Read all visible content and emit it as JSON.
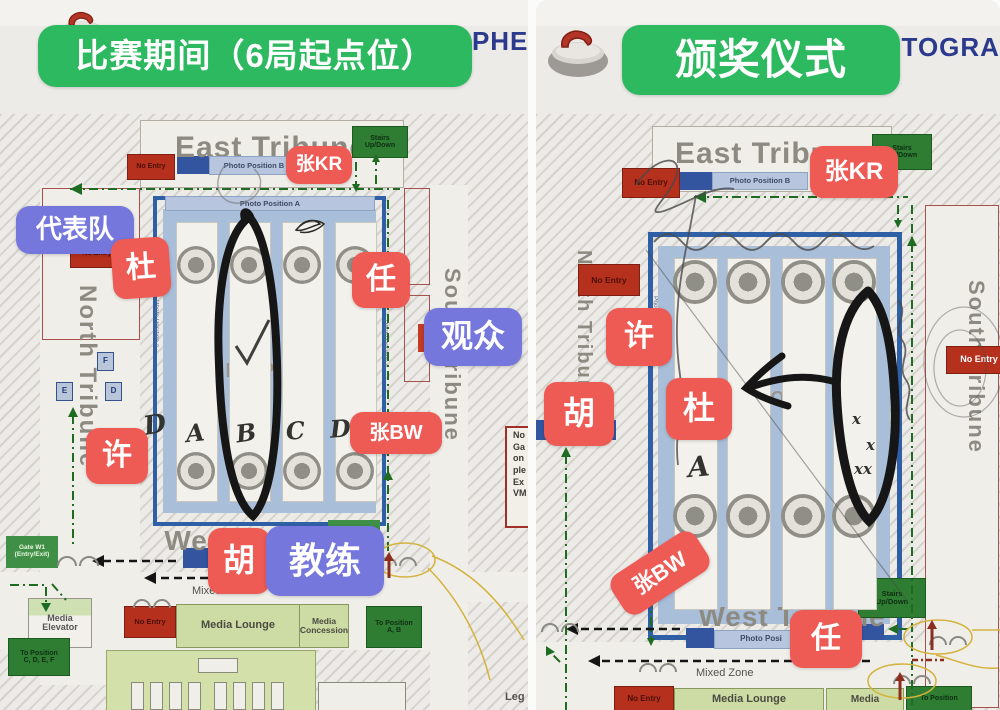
{
  "doc_title": "NAC MAP FOR PHOTOGRAPHERS",
  "colors": {
    "banner_green": "#2cb95f",
    "label_red": "#ee5a54",
    "label_purple": "#7577dd",
    "title_navy": "#2b3a8c",
    "no_entry_red": "#b5301d",
    "stairs_green": "#2e7d32",
    "lounge_green": "#cddca4",
    "rink_blue": "#2f5fa5",
    "rink_fill": "#a9bed8",
    "marker_black": "#161616",
    "paper": "#edebe7"
  },
  "panels": [
    {
      "id": "left",
      "items": [
        {
          "n": "banner-competition",
          "t": "比赛期间（6局起点位）",
          "c": "banner",
          "x": 38,
          "y": 25,
          "w": 434,
          "h": 62,
          "fs": 33,
          "it": true
        },
        {
          "n": "map-title",
          "t": "NAC MAP FOR PHOTOGRAPHERS",
          "c": "navy",
          "x": 112,
          "y": 28,
          "w": 430,
          "h": 34,
          "fs": 26
        },
        {
          "n": "label-zhang-kr",
          "t": "张KR",
          "c": "red",
          "x": 286,
          "y": 146,
          "w": 66,
          "h": 38,
          "fs": 19,
          "it": true
        },
        {
          "n": "label-delegation",
          "t": "代表队",
          "c": "purple",
          "x": 16,
          "y": 206,
          "w": 118,
          "h": 48,
          "fs": 26,
          "it": true
        },
        {
          "n": "label-du",
          "t": "杜",
          "c": "red",
          "x": 112,
          "y": 238,
          "w": 58,
          "h": 60,
          "fs": 30,
          "rot": -4,
          "it": true
        },
        {
          "n": "label-ren",
          "t": "任",
          "c": "red",
          "x": 352,
          "y": 252,
          "w": 58,
          "h": 56,
          "fs": 30,
          "it": true
        },
        {
          "n": "label-audience",
          "t": "观众",
          "c": "purple",
          "x": 424,
          "y": 308,
          "w": 98,
          "h": 58,
          "fs": 32,
          "it": true
        },
        {
          "n": "label-xu",
          "t": "许",
          "c": "red",
          "x": 86,
          "y": 428,
          "w": 62,
          "h": 56,
          "fs": 30,
          "it": true
        },
        {
          "n": "label-zhang-bw",
          "t": "张BW",
          "c": "red",
          "x": 350,
          "y": 412,
          "w": 92,
          "h": 42,
          "fs": 20,
          "it": true
        },
        {
          "n": "label-hu",
          "t": "胡",
          "c": "red",
          "x": 208,
          "y": 528,
          "w": 62,
          "h": 66,
          "fs": 32,
          "it": true
        },
        {
          "n": "label-coach",
          "t": "教练",
          "c": "purple",
          "x": 266,
          "y": 526,
          "w": 118,
          "h": 70,
          "fs": 36,
          "it": true
        },
        {
          "n": "east-tribune-label",
          "t": "East Tribune",
          "c": "lg",
          "x": 140,
          "y": 128,
          "w": 262,
          "h": 40,
          "fs": 30
        },
        {
          "n": "no-entry-east",
          "t": "No Entry",
          "c": "ne",
          "x": 127,
          "y": 154,
          "w": 46,
          "h": 24,
          "fs": 7
        },
        {
          "n": "photo-position-b-bar",
          "t": "Photo Position B",
          "c": "lb",
          "x": 209,
          "y": 156,
          "w": 88,
          "h": 17,
          "fs": 7.5
        },
        {
          "n": "stairs-east",
          "t": "Stairs\nUp/Down",
          "c": "gb",
          "x": 352,
          "y": 126,
          "w": 54,
          "h": 30,
          "fs": 7
        },
        {
          "n": "photo-position-a-bar",
          "t": "Photo Position A",
          "c": "lb",
          "x": 165,
          "y": 196,
          "w": 208,
          "h": 13,
          "fs": 7.5
        },
        {
          "n": "photo-position-a-west",
          "t": "Photo Position A",
          "c": "vtt",
          "x": 148,
          "y": 300,
          "w": 11,
          "h": 130,
          "fs": 6.5
        },
        {
          "n": "photo-position-a-east",
          "t": "Photo Position A",
          "c": "vtt",
          "x": 377,
          "y": 320,
          "w": 11,
          "h": 130,
          "fs": 6.5
        },
        {
          "n": "no-entry-northwest",
          "t": "No Entry",
          "c": "ne",
          "x": 70,
          "y": 240,
          "w": 52,
          "h": 26,
          "fs": 7
        },
        {
          "n": "fop-label",
          "t": "FOP",
          "c": "md",
          "x": 222,
          "y": 358,
          "w": 60,
          "h": 26,
          "fs": 20
        },
        {
          "n": "north-tribune-label",
          "t": "North Tribune",
          "c": "vt",
          "x": 70,
          "y": 285,
          "w": 30,
          "h": 370,
          "fs": 24
        },
        {
          "n": "camera-square-f",
          "t": "F",
          "c": "sq",
          "x": 97,
          "y": 352,
          "w": 15,
          "h": 17,
          "fs": 8
        },
        {
          "n": "camera-square-e",
          "t": "E",
          "c": "sq",
          "x": 56,
          "y": 382,
          "w": 15,
          "h": 17,
          "fs": 8
        },
        {
          "n": "camera-square-d",
          "t": "D",
          "c": "sq",
          "x": 105,
          "y": 382,
          "w": 15,
          "h": 17,
          "fs": 8
        },
        {
          "n": "gate-w1",
          "t": "Gate W1\n(Entry/Exit)",
          "c": "gate",
          "x": 6,
          "y": 536,
          "w": 52,
          "h": 32,
          "fs": 6.5
        },
        {
          "n": "west-tribune-label",
          "t": "West Tribune",
          "c": "lg",
          "x": 168,
          "y": 524,
          "w": 180,
          "h": 34,
          "fs": 28
        },
        {
          "n": "mixed-zone-label",
          "t": "Mixed Zone",
          "c": "sm",
          "x": 192,
          "y": 586,
          "w": 80,
          "h": 16,
          "fs": 11
        },
        {
          "n": "media-elevator",
          "t": "Media\nElevator",
          "c": "elev",
          "x": 28,
          "y": 598,
          "w": 62,
          "h": 48,
          "fs": 9
        },
        {
          "n": "no-entry-west",
          "t": "No Entry",
          "c": "ne",
          "x": 124,
          "y": 606,
          "w": 50,
          "h": 30,
          "fs": 7.5
        },
        {
          "n": "media-lounge",
          "t": "Media Lounge",
          "c": "lounge",
          "x": 176,
          "y": 604,
          "w": 122,
          "h": 42,
          "fs": 11
        },
        {
          "n": "media-concession",
          "t": "Media\nConcession",
          "c": "lounge",
          "x": 299,
          "y": 604,
          "w": 48,
          "h": 42,
          "fs": 8.5
        },
        {
          "n": "to-position-ab",
          "t": "To Position\nA, B",
          "c": "gb",
          "x": 366,
          "y": 606,
          "w": 54,
          "h": 40,
          "fs": 7
        },
        {
          "n": "to-position-cdef",
          "t": "To Position\nC, D, E, F",
          "c": "gb",
          "x": 8,
          "y": 638,
          "w": 60,
          "h": 36,
          "fs": 7
        },
        {
          "n": "south-tribune-label",
          "t": "South Tribune",
          "c": "vt",
          "x": 434,
          "y": 268,
          "w": 30,
          "h": 280,
          "fs": 22
        },
        {
          "n": "note-box",
          "t": "No\nGa\non\nple\nEx\nVM",
          "c": "note",
          "x": 505,
          "y": 426,
          "w": 40,
          "h": 96,
          "fs": 9
        },
        {
          "n": "legend-fragment",
          "t": "Leg",
          "c": "smb",
          "x": 505,
          "y": 692,
          "w": 40,
          "h": 16,
          "fs": 11
        },
        {
          "n": "hand-letter-d0",
          "t": "D",
          "c": "hand",
          "x": 144,
          "y": 412,
          "w": 24,
          "h": 30,
          "fs": 26,
          "rot": -10
        },
        {
          "n": "hand-letter-a",
          "t": "A",
          "c": "hand",
          "x": 186,
          "y": 420,
          "w": 22,
          "h": 28,
          "fs": 24,
          "rot": -6
        },
        {
          "n": "hand-letter-b",
          "t": "B",
          "c": "hand",
          "x": 236,
          "y": 420,
          "w": 22,
          "h": 28,
          "fs": 24,
          "rot": -8
        },
        {
          "n": "hand-letter-c",
          "t": "C",
          "c": "hand",
          "x": 286,
          "y": 418,
          "w": 22,
          "h": 28,
          "fs": 24,
          "rot": -5
        },
        {
          "n": "hand-letter-d",
          "t": "D",
          "c": "hand",
          "x": 330,
          "y": 416,
          "w": 22,
          "h": 28,
          "fs": 24,
          "rot": -4
        }
      ]
    },
    {
      "id": "right",
      "items": [
        {
          "n": "banner-ceremony",
          "t": "颁奖仪式",
          "c": "banner",
          "x": 86,
          "y": 25,
          "w": 278,
          "h": 70,
          "fs": 42,
          "it": true
        },
        {
          "n": "map-title",
          "t": "NAC MAP FOR PHOTOGRAPHERS",
          "c": "navy",
          "x": 104,
          "y": 34,
          "w": 600,
          "h": 34,
          "fs": 26
        },
        {
          "n": "label-zhang-kr",
          "t": "张KR",
          "c": "red",
          "x": 274,
          "y": 146,
          "w": 88,
          "h": 52,
          "fs": 24,
          "it": true
        },
        {
          "n": "label-xu",
          "t": "许",
          "c": "red",
          "x": 70,
          "y": 308,
          "w": 66,
          "h": 58,
          "fs": 30,
          "it": true
        },
        {
          "n": "label-hu",
          "t": "胡",
          "c": "red",
          "x": 8,
          "y": 382,
          "w": 70,
          "h": 64,
          "fs": 32,
          "it": true
        },
        {
          "n": "label-du",
          "t": "杜",
          "c": "red",
          "x": 130,
          "y": 378,
          "w": 66,
          "h": 62,
          "fs": 32,
          "it": true
        },
        {
          "n": "label-zhang-bw",
          "t": "张BW",
          "c": "red",
          "x": 74,
          "y": 550,
          "w": 100,
          "h": 46,
          "fs": 22,
          "rot": -33,
          "it": true
        },
        {
          "n": "label-ren",
          "t": "任",
          "c": "red",
          "x": 254,
          "y": 610,
          "w": 72,
          "h": 58,
          "fs": 30,
          "it": true
        },
        {
          "n": "east-tribune-label",
          "t": "East Tribune",
          "c": "lg",
          "x": 116,
          "y": 134,
          "w": 238,
          "h": 40,
          "fs": 30
        },
        {
          "n": "no-entry-east",
          "t": "No Entry",
          "c": "ne",
          "x": 86,
          "y": 168,
          "w": 56,
          "h": 28,
          "fs": 8
        },
        {
          "n": "photo-position-b-bar",
          "t": "Photo Position B",
          "c": "lb",
          "x": 176,
          "y": 172,
          "w": 94,
          "h": 16,
          "fs": 7.5
        },
        {
          "n": "stairs-east",
          "t": "Stairs\nUp/Down",
          "c": "gb",
          "x": 336,
          "y": 134,
          "w": 58,
          "h": 34,
          "fs": 7
        },
        {
          "n": "north-tribune-label",
          "t": "North Tribune",
          "c": "vt",
          "x": 30,
          "y": 250,
          "w": 28,
          "h": 260,
          "fs": 20
        },
        {
          "n": "no-entry-northwest",
          "t": "No Entry",
          "c": "ne",
          "x": 42,
          "y": 264,
          "w": 60,
          "h": 30,
          "fs": 8.5
        },
        {
          "n": "photo-position-a-west",
          "t": "Photo Position A",
          "c": "vtt",
          "x": 108,
          "y": 296,
          "w": 14,
          "h": 95,
          "fs": 6.5
        },
        {
          "n": "fop-label",
          "t": "FOP",
          "c": "md",
          "x": 214,
          "y": 386,
          "w": 60,
          "h": 24,
          "fs": 18
        },
        {
          "n": "hand-letter-a",
          "t": "A",
          "c": "hand",
          "x": 152,
          "y": 452,
          "w": 26,
          "h": 34,
          "fs": 28,
          "rot": -5
        },
        {
          "n": "hand-x1",
          "t": "x",
          "c": "hand",
          "x": 316,
          "y": 412,
          "w": 14,
          "h": 16,
          "fs": 15
        },
        {
          "n": "hand-x2",
          "t": "x",
          "c": "hand",
          "x": 330,
          "y": 438,
          "w": 14,
          "h": 16,
          "fs": 15
        },
        {
          "n": "hand-x3",
          "t": "xx",
          "c": "hand",
          "x": 318,
          "y": 462,
          "w": 26,
          "h": 16,
          "fs": 15
        },
        {
          "n": "south-tribune-label",
          "t": "South Tribune",
          "c": "vt",
          "x": 422,
          "y": 280,
          "w": 30,
          "h": 230,
          "fs": 22
        },
        {
          "n": "no-entry-south",
          "t": "No Entry",
          "c": "new",
          "x": 410,
          "y": 346,
          "w": 64,
          "h": 26,
          "fs": 9
        },
        {
          "n": "west-tribune-label",
          "t": "West Tribune",
          "c": "lg",
          "x": 156,
          "y": 600,
          "w": 200,
          "h": 34,
          "fs": 28
        },
        {
          "n": "photo-position-w-bar",
          "t": "Photo Posi",
          "c": "lb",
          "x": 178,
          "y": 630,
          "w": 92,
          "h": 17,
          "fs": 8
        },
        {
          "n": "stairs-west",
          "t": "Stairs\nUp/Down",
          "c": "gb",
          "x": 322,
          "y": 578,
          "w": 66,
          "h": 38,
          "fs": 7.5
        },
        {
          "n": "mixed-zone-label",
          "t": "Mixed Zone",
          "c": "sm",
          "x": 160,
          "y": 668,
          "w": 84,
          "h": 16,
          "fs": 11
        },
        {
          "n": "no-entry-west",
          "t": "No Entry",
          "c": "ne",
          "x": 78,
          "y": 686,
          "w": 58,
          "h": 24,
          "fs": 8
        },
        {
          "n": "media-lounge",
          "t": "Media Lounge",
          "c": "lounge",
          "x": 138,
          "y": 688,
          "w": 148,
          "h": 22,
          "fs": 11
        },
        {
          "n": "media-concession",
          "t": "Media",
          "c": "lounge",
          "x": 290,
          "y": 688,
          "w": 76,
          "h": 22,
          "fs": 10
        },
        {
          "n": "to-position",
          "t": "To Position",
          "c": "gb",
          "x": 370,
          "y": 686,
          "w": 64,
          "h": 24,
          "fs": 7
        }
      ]
    }
  ]
}
